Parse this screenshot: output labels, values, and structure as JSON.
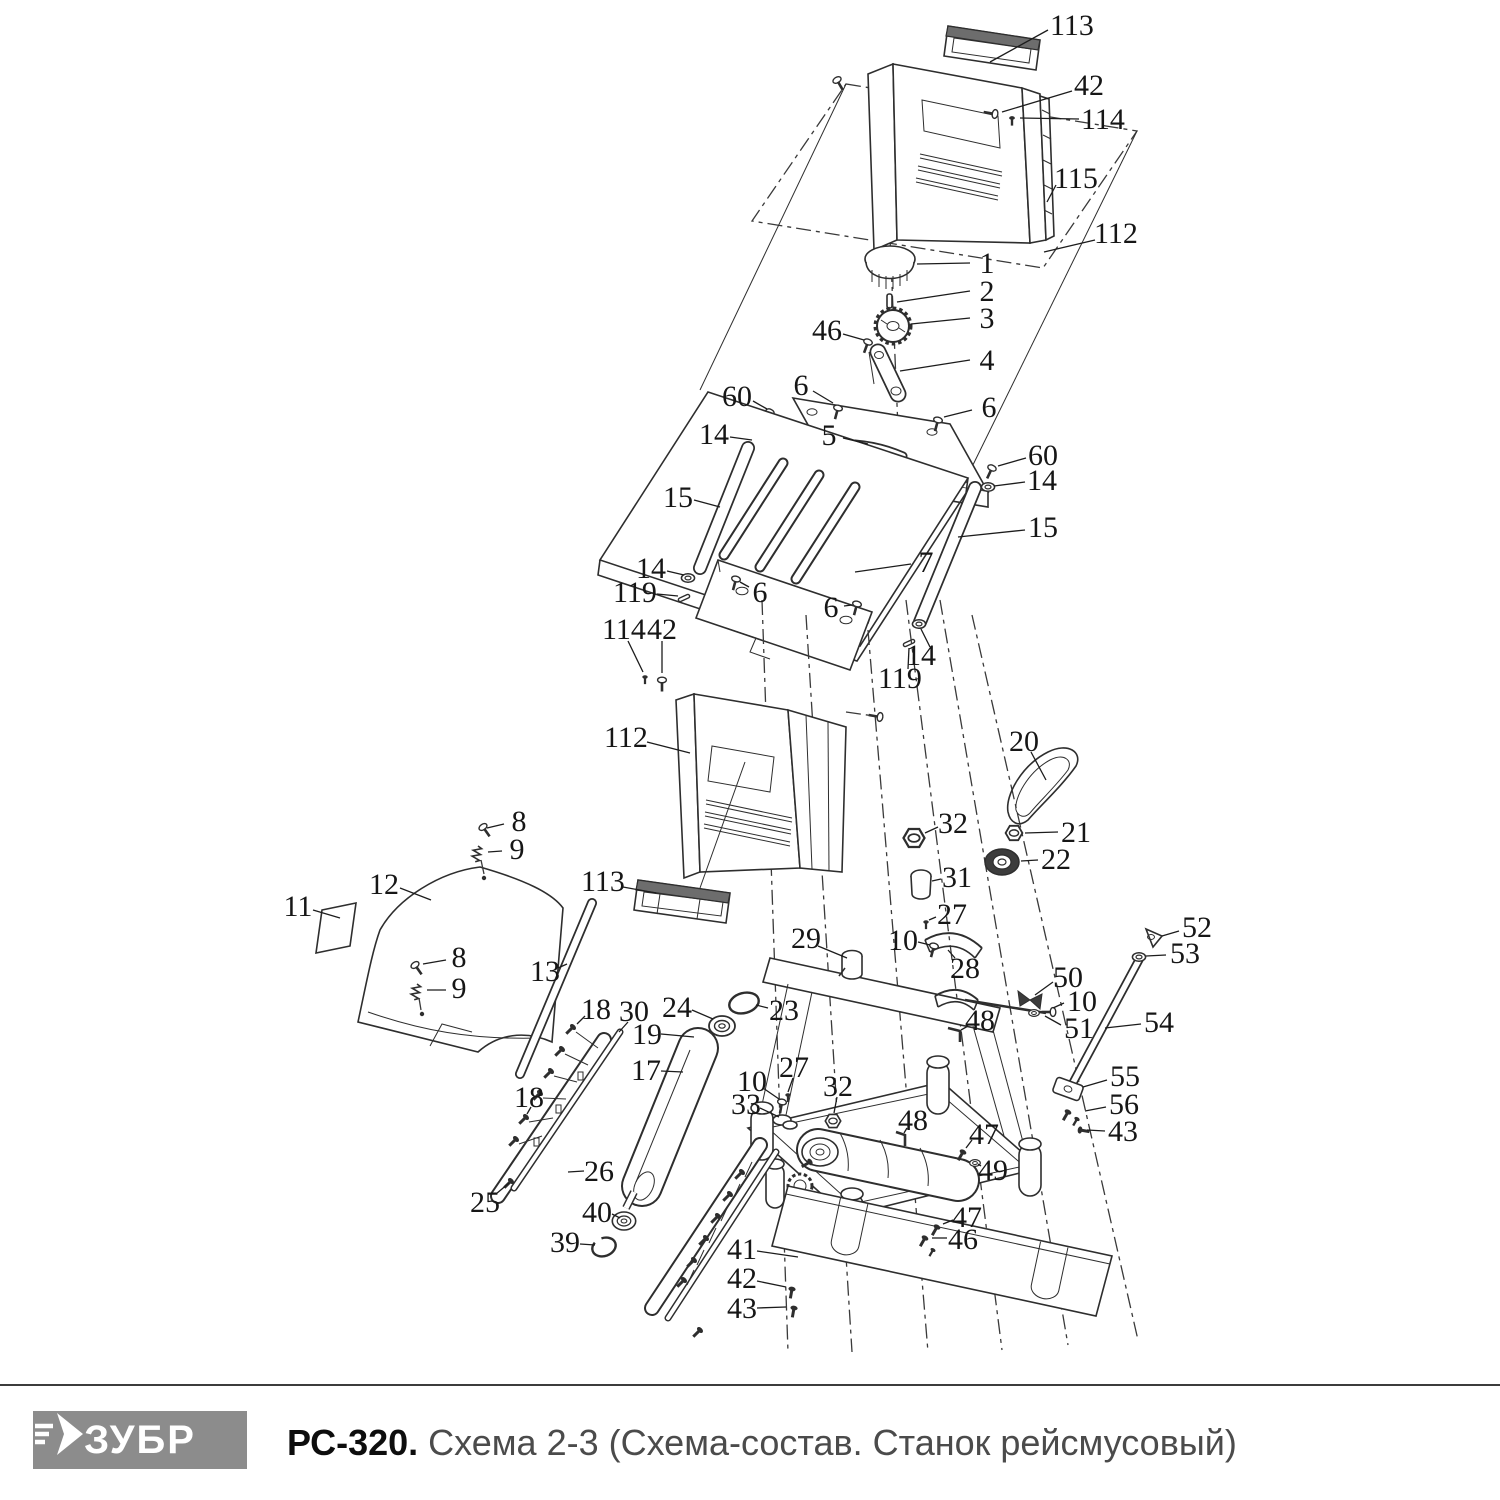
{
  "colors": {
    "line": "#2e2e2e",
    "leader": "#1c1c1c",
    "label": "#161616",
    "logo_bg": "#8c8c8c",
    "logo_fg": "#ffffff",
    "title_model": "#0d0d0d",
    "title_rest": "#4b4b4b"
  },
  "footer": {
    "logo_text": "ЗУБР",
    "title_model": "РС-320.",
    "title_rest": " Схема 2-3 (Схема-состав. Станок рейсмусовый)"
  },
  "diagram": {
    "description": "Exploded parts view of thickness planer PC-320, scheme 2-3",
    "labels": [
      {
        "t": "113",
        "x": 1072,
        "y": 25,
        "l": [
          1048,
          30,
          990,
          62
        ]
      },
      {
        "t": "42",
        "x": 1089,
        "y": 85,
        "l": [
          1072,
          91,
          1002,
          112
        ]
      },
      {
        "t": "114",
        "x": 1103,
        "y": 119,
        "l": [
          1079,
          119,
          1020,
          118
        ]
      },
      {
        "t": "115",
        "x": 1076,
        "y": 178,
        "l": [
          1056,
          185,
          1047,
          202
        ]
      },
      {
        "t": "112",
        "x": 1116,
        "y": 233,
        "l": [
          1095,
          240,
          1044,
          252
        ]
      },
      {
        "t": "1",
        "x": 987,
        "y": 263,
        "l": [
          970,
          263,
          917,
          264
        ]
      },
      {
        "t": "2",
        "x": 987,
        "y": 291,
        "l": [
          970,
          291,
          897,
          302
        ]
      },
      {
        "t": "3",
        "x": 987,
        "y": 318,
        "l": [
          970,
          318,
          911,
          324
        ]
      },
      {
        "t": "46",
        "x": 827,
        "y": 330,
        "l": [
          843,
          334,
          864,
          340
        ]
      },
      {
        "t": "4",
        "x": 987,
        "y": 360,
        "l": [
          970,
          360,
          900,
          371
        ]
      },
      {
        "t": "60",
        "x": 737,
        "y": 396,
        "l": [
          753,
          401,
          767,
          409
        ]
      },
      {
        "t": "6",
        "x": 801,
        "y": 385,
        "l": [
          813,
          391,
          833,
          403
        ]
      },
      {
        "t": "6",
        "x": 989,
        "y": 407,
        "l": [
          972,
          410,
          944,
          417
        ]
      },
      {
        "t": "14",
        "x": 714,
        "y": 434,
        "l": [
          730,
          437,
          752,
          440
        ]
      },
      {
        "t": "5",
        "x": 829,
        "y": 435,
        "l": [
          843,
          438,
          868,
          444
        ]
      },
      {
        "t": "60",
        "x": 1043,
        "y": 455,
        "l": [
          1026,
          458,
          998,
          466
        ]
      },
      {
        "t": "14",
        "x": 1042,
        "y": 480,
        "l": [
          1025,
          482,
          994,
          486
        ]
      },
      {
        "t": "15",
        "x": 678,
        "y": 497,
        "l": [
          694,
          500,
          720,
          507
        ]
      },
      {
        "t": "15",
        "x": 1043,
        "y": 527,
        "l": [
          1025,
          530,
          958,
          537
        ]
      },
      {
        "t": "7",
        "x": 926,
        "y": 562,
        "l": [
          911,
          564,
          855,
          572
        ]
      },
      {
        "t": "14",
        "x": 651,
        "y": 568,
        "l": [
          667,
          571,
          684,
          575
        ]
      },
      {
        "t": "119",
        "x": 635,
        "y": 592,
        "l": [
          657,
          594,
          678,
          596
        ]
      },
      {
        "t": "6",
        "x": 760,
        "y": 592,
        "l": [
          749,
          587,
          740,
          582
        ]
      },
      {
        "t": "6",
        "x": 831,
        "y": 607,
        "l": [
          844,
          606,
          852,
          605
        ]
      },
      {
        "t": "14",
        "x": 921,
        "y": 655,
        "l": [
          930,
          647,
          921,
          629
        ]
      },
      {
        "t": "119",
        "x": 900,
        "y": 678,
        "l": [
          908,
          669,
          909,
          648
        ]
      },
      {
        "t": "114",
        "x": 624,
        "y": 629,
        "l": [
          628,
          641,
          643,
          672
        ]
      },
      {
        "t": "42",
        "x": 662,
        "y": 629,
        "l": [
          662,
          641,
          662,
          673
        ]
      },
      {
        "t": "112",
        "x": 626,
        "y": 737,
        "l": [
          647,
          742,
          690,
          753
        ]
      },
      {
        "t": "20",
        "x": 1024,
        "y": 741,
        "l": [
          1031,
          752,
          1046,
          780
        ]
      },
      {
        "t": "8",
        "x": 519,
        "y": 821,
        "l": [
          504,
          824,
          487,
          828
        ]
      },
      {
        "t": "9",
        "x": 517,
        "y": 849,
        "l": [
          502,
          851,
          488,
          852
        ]
      },
      {
        "t": "32",
        "x": 953,
        "y": 823,
        "l": [
          938,
          827,
          925,
          833
        ]
      },
      {
        "t": "21",
        "x": 1076,
        "y": 832,
        "l": [
          1058,
          832,
          1025,
          833
        ]
      },
      {
        "t": "22",
        "x": 1056,
        "y": 859,
        "l": [
          1038,
          860,
          1021,
          861
        ]
      },
      {
        "t": "31",
        "x": 957,
        "y": 877,
        "l": [
          941,
          879,
          932,
          881
        ]
      },
      {
        "t": "12",
        "x": 384,
        "y": 884,
        "l": [
          400,
          888,
          431,
          900
        ]
      },
      {
        "t": "113",
        "x": 603,
        "y": 881,
        "l": [
          623,
          887,
          656,
          893
        ]
      },
      {
        "t": "11",
        "x": 298,
        "y": 906,
        "l": [
          313,
          910,
          340,
          918
        ]
      },
      {
        "t": "27",
        "x": 952,
        "y": 914,
        "l": [
          936,
          917,
          929,
          920
        ]
      },
      {
        "t": "10",
        "x": 903,
        "y": 940,
        "l": [
          918,
          942,
          930,
          945
        ]
      },
      {
        "t": "29",
        "x": 806,
        "y": 938,
        "l": [
          818,
          946,
          847,
          958
        ]
      },
      {
        "t": "28",
        "x": 965,
        "y": 968,
        "l": [
          955,
          958,
          948,
          950
        ]
      },
      {
        "t": "52",
        "x": 1197,
        "y": 927,
        "l": [
          1179,
          931,
          1162,
          936
        ]
      },
      {
        "t": "53",
        "x": 1185,
        "y": 953,
        "l": [
          1166,
          955,
          1146,
          956
        ]
      },
      {
        "t": "8",
        "x": 459,
        "y": 957,
        "l": [
          446,
          960,
          423,
          964
        ]
      },
      {
        "t": "9",
        "x": 459,
        "y": 988,
        "l": [
          446,
          990,
          427,
          990
        ]
      },
      {
        "t": "13",
        "x": 545,
        "y": 971,
        "l": [
          558,
          968,
          567,
          964
        ]
      },
      {
        "t": "50",
        "x": 1068,
        "y": 977,
        "l": [
          1053,
          982,
          1035,
          995
        ]
      },
      {
        "t": "10",
        "x": 1082,
        "y": 1001,
        "l": [
          1064,
          1003,
          1053,
          1008
        ]
      },
      {
        "t": "51",
        "x": 1079,
        "y": 1028,
        "l": [
          1061,
          1025,
          1045,
          1016
        ]
      },
      {
        "t": "18",
        "x": 596,
        "y": 1009,
        "l": [
          585,
          1016,
          577,
          1024
        ]
      },
      {
        "t": "30",
        "x": 634,
        "y": 1011,
        "l": [
          628,
          1022,
          619,
          1032
        ]
      },
      {
        "t": "24",
        "x": 677,
        "y": 1007,
        "l": [
          692,
          1010,
          713,
          1019
        ]
      },
      {
        "t": "23",
        "x": 784,
        "y": 1010,
        "l": [
          768,
          1008,
          756,
          1005
        ]
      },
      {
        "t": "19",
        "x": 647,
        "y": 1034,
        "l": [
          661,
          1034,
          694,
          1037
        ]
      },
      {
        "t": "48",
        "x": 980,
        "y": 1020,
        "l": [
          968,
          1026,
          961,
          1030
        ]
      },
      {
        "t": "54",
        "x": 1159,
        "y": 1022,
        "l": [
          1141,
          1024,
          1105,
          1028
        ]
      },
      {
        "t": "17",
        "x": 646,
        "y": 1070,
        "l": [
          661,
          1071,
          683,
          1072
        ]
      },
      {
        "t": "10",
        "x": 752,
        "y": 1081,
        "l": [
          763,
          1088,
          779,
          1099
        ]
      },
      {
        "t": "27",
        "x": 794,
        "y": 1067,
        "l": [
          793,
          1078,
          788,
          1092
        ]
      },
      {
        "t": "55",
        "x": 1125,
        "y": 1076,
        "l": [
          1107,
          1080,
          1083,
          1087
        ]
      },
      {
        "t": "32",
        "x": 838,
        "y": 1086,
        "l": [
          837,
          1097,
          834,
          1113
        ]
      },
      {
        "t": "33",
        "x": 746,
        "y": 1104,
        "l": [
          760,
          1108,
          779,
          1117
        ]
      },
      {
        "t": "56",
        "x": 1124,
        "y": 1104,
        "l": [
          1106,
          1107,
          1085,
          1111
        ]
      },
      {
        "t": "18",
        "x": 529,
        "y": 1097,
        "l": [
          531,
          1107,
          527,
          1114
        ]
      },
      {
        "t": "48",
        "x": 913,
        "y": 1120,
        "l": [
          907,
          1128,
          904,
          1133
        ]
      },
      {
        "t": "43",
        "x": 1123,
        "y": 1131,
        "l": [
          1105,
          1131,
          1087,
          1130
        ]
      },
      {
        "t": "47",
        "x": 984,
        "y": 1134,
        "l": [
          972,
          1140,
          966,
          1148
        ]
      },
      {
        "t": "26",
        "x": 599,
        "y": 1171,
        "l": [
          584,
          1171,
          568,
          1172
        ]
      },
      {
        "t": "49",
        "x": 993,
        "y": 1170,
        "l": [
          981,
          1166,
          978,
          1164
        ]
      },
      {
        "t": "25",
        "x": 485,
        "y": 1202,
        "l": [
          496,
          1194,
          509,
          1183
        ]
      },
      {
        "t": "40",
        "x": 597,
        "y": 1212,
        "l": [
          612,
          1214,
          620,
          1218
        ]
      },
      {
        "t": "47",
        "x": 967,
        "y": 1217,
        "l": [
          953,
          1220,
          943,
          1224
        ]
      },
      {
        "t": "39",
        "x": 565,
        "y": 1242,
        "l": [
          580,
          1244,
          595,
          1245
        ]
      },
      {
        "t": "46",
        "x": 963,
        "y": 1239,
        "l": [
          947,
          1238,
          932,
          1238
        ]
      },
      {
        "t": "41",
        "x": 742,
        "y": 1249,
        "l": [
          757,
          1251,
          798,
          1257
        ]
      },
      {
        "t": "42",
        "x": 742,
        "y": 1278,
        "l": [
          757,
          1281,
          786,
          1287
        ]
      },
      {
        "t": "43",
        "x": 742,
        "y": 1308,
        "l": [
          757,
          1308,
          786,
          1307
        ]
      }
    ]
  }
}
